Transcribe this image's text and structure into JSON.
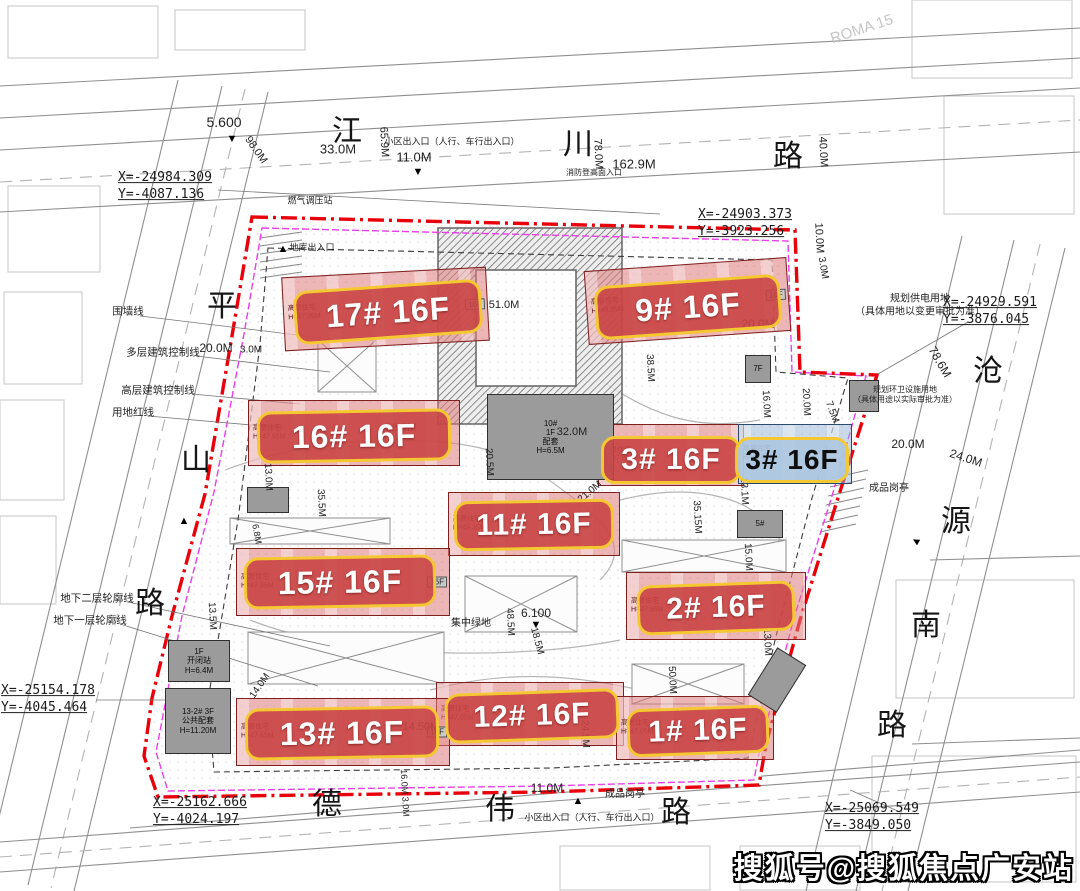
{
  "watermark": {
    "text": "搜狐号@搜狐焦点广安站"
  },
  "roads": {
    "top": "江川路",
    "left": "平山路",
    "right": "沧源南路",
    "bottom": "德伟路",
    "chars": [
      {
        "c": "江",
        "x": 347,
        "y": 128
      },
      {
        "c": "川",
        "x": 578,
        "y": 141
      },
      {
        "c": "路",
        "x": 788,
        "y": 153
      },
      {
        "c": "平",
        "x": 222,
        "y": 303
      },
      {
        "c": "山",
        "x": 196,
        "y": 457
      },
      {
        "c": "路",
        "x": 150,
        "y": 600
      },
      {
        "c": "沧",
        "x": 988,
        "y": 368
      },
      {
        "c": "源",
        "x": 956,
        "y": 518
      },
      {
        "c": "南",
        "x": 926,
        "y": 622
      },
      {
        "c": "路",
        "x": 892,
        "y": 722
      },
      {
        "c": "德",
        "x": 327,
        "y": 801
      },
      {
        "c": "伟",
        "x": 500,
        "y": 806
      },
      {
        "c": "路",
        "x": 676,
        "y": 809
      }
    ]
  },
  "buildings": [
    {
      "id": "17",
      "label": "17# 16F",
      "variant": "red",
      "chip": {
        "x": 388,
        "y": 312,
        "w": 188,
        "h": 54,
        "rot": -4,
        "fs": 32
      },
      "fp": {
        "x": 283,
        "y": 272,
        "w": 205,
        "h": 74,
        "rot": -3
      },
      "sub": [
        "高层住宅",
        "H=47.05M"
      ],
      "end": "16F"
    },
    {
      "id": "9",
      "label": "9# 16F",
      "variant": "red",
      "chip": {
        "x": 688,
        "y": 307,
        "w": 186,
        "h": 54,
        "rot": -4,
        "fs": 32
      },
      "fp": {
        "x": 586,
        "y": 264,
        "w": 203,
        "h": 74,
        "rot": -4
      },
      "sub": [
        "高层住宅",
        "H=49.35M"
      ],
      "end": "16F"
    },
    {
      "id": "16",
      "label": "16# 16F",
      "variant": "red",
      "chip": {
        "x": 354,
        "y": 436,
        "w": 194,
        "h": 52,
        "rot": -1,
        "fs": 32
      },
      "fp": {
        "x": 248,
        "y": 400,
        "w": 212,
        "h": 66,
        "rot": 0
      },
      "sub": [
        "高层住宅",
        "H=47.95M"
      ]
    },
    {
      "id": "3",
      "label": "3# 16F",
      "variant": "red",
      "chip": {
        "x": 671,
        "y": 460,
        "w": 140,
        "h": 48,
        "rot": 0,
        "fs": 30
      },
      "fp": {
        "x": 598,
        "y": 424,
        "w": 146,
        "h": 62,
        "rot": 0
      },
      "sub": [
        "高层住宅",
        "H=47.95M"
      ]
    },
    {
      "id": "3b",
      "label": "3# 16F",
      "variant": "blue",
      "chip": {
        "x": 792,
        "y": 460,
        "w": 114,
        "h": 46,
        "rot": 0,
        "fs": 28
      },
      "fp": {
        "x": 738,
        "y": 424,
        "w": 114,
        "h": 60,
        "rot": 0
      },
      "sub": [
        "高层住宅",
        "H=47.95M"
      ]
    },
    {
      "id": "11",
      "label": "11# 16F",
      "variant": "red",
      "chip": {
        "x": 534,
        "y": 525,
        "w": 160,
        "h": 50,
        "rot": -1,
        "fs": 30
      },
      "fp": {
        "x": 448,
        "y": 492,
        "w": 172,
        "h": 64,
        "rot": 0
      },
      "sub": [
        "高层住宅",
        "H=49.35M"
      ]
    },
    {
      "id": "15",
      "label": "15# 16F",
      "variant": "red",
      "chip": {
        "x": 340,
        "y": 582,
        "w": 192,
        "h": 52,
        "rot": -1,
        "fs": 32
      },
      "fp": {
        "x": 236,
        "y": 548,
        "w": 214,
        "h": 68,
        "rot": 0
      },
      "sub": [
        "高层住宅",
        "H=47.95M"
      ],
      "end": "16F"
    },
    {
      "id": "2",
      "label": "2# 16F",
      "variant": "red",
      "chip": {
        "x": 716,
        "y": 608,
        "w": 158,
        "h": 50,
        "rot": -2,
        "fs": 30
      },
      "fp": {
        "x": 626,
        "y": 572,
        "w": 180,
        "h": 68,
        "rot": 0
      },
      "sub": [
        "高层住宅",
        "H=47.95M"
      ]
    },
    {
      "id": "12",
      "label": "12# 16F",
      "variant": "red",
      "chip": {
        "x": 532,
        "y": 716,
        "w": 174,
        "h": 50,
        "rot": -2,
        "fs": 30
      },
      "fp": {
        "x": 436,
        "y": 682,
        "w": 188,
        "h": 64,
        "rot": 0
      },
      "sub": [
        "高层住宅",
        "H=47.05M"
      ]
    },
    {
      "id": "13",
      "label": "13# 16F",
      "variant": "red",
      "chip": {
        "x": 342,
        "y": 733,
        "w": 194,
        "h": 52,
        "rot": -1,
        "fs": 32
      },
      "fp": {
        "x": 236,
        "y": 698,
        "w": 214,
        "h": 68,
        "rot": 0
      },
      "sub": [
        "高层住宅",
        "H=47.65M"
      ],
      "end": "16F"
    },
    {
      "id": "1",
      "label": "1# 16F",
      "variant": "red",
      "chip": {
        "x": 698,
        "y": 731,
        "w": 142,
        "h": 48,
        "rot": -2,
        "fs": 30
      },
      "fp": {
        "x": 616,
        "y": 696,
        "w": 158,
        "h": 64,
        "rot": 0
      },
      "sub": [
        "高层住宅",
        "H=47.05M"
      ]
    }
  ],
  "gray_buildings": [
    {
      "x": 487,
      "y": 394,
      "w": 127,
      "h": 86,
      "lines": [
        "10#",
        "1F",
        "配套",
        "H=6.5M"
      ]
    },
    {
      "x": 168,
      "y": 640,
      "w": 62,
      "h": 42,
      "lines": [
        "1F",
        "开闭站",
        "H=6.4M"
      ]
    },
    {
      "x": 165,
      "y": 688,
      "w": 66,
      "h": 66,
      "lines": [
        "13-2# 3F",
        "公共配套",
        "H=11.20M"
      ]
    },
    {
      "x": 849,
      "y": 380,
      "w": 30,
      "h": 32,
      "lines": []
    },
    {
      "x": 737,
      "y": 510,
      "w": 46,
      "h": 28,
      "lines": [
        "5#"
      ]
    },
    {
      "x": 247,
      "y": 487,
      "w": 42,
      "h": 26,
      "lines": []
    },
    {
      "x": 745,
      "y": 355,
      "w": 26,
      "h": 28,
      "lines": [
        "7F"
      ]
    },
    {
      "x": 760,
      "y": 652,
      "w": 34,
      "h": 56,
      "rot": 32,
      "lines": []
    }
  ],
  "dimensions": [
    {
      "t": "5.600",
      "x": 224,
      "y": 122,
      "r": 0,
      "fs": 14
    },
    {
      "t": "98.0M",
      "x": 256,
      "y": 150,
      "r": 55,
      "fs": 11
    },
    {
      "t": "65.9M",
      "x": 384,
      "y": 142,
      "r": 87,
      "fs": 11
    },
    {
      "t": "33.0M",
      "x": 338,
      "y": 149,
      "r": 0,
      "fs": 13
    },
    {
      "t": "11.0M",
      "x": 414,
      "y": 157,
      "r": 0,
      "fs": 13
    },
    {
      "t": "162.9M",
      "x": 634,
      "y": 164,
      "r": 0,
      "fs": 13
    },
    {
      "t": "78.0M",
      "x": 598,
      "y": 154,
      "r": 87,
      "fs": 11
    },
    {
      "t": "40.0M",
      "x": 823,
      "y": 152,
      "r": 87,
      "fs": 11
    },
    {
      "t": "10.0M",
      "x": 819,
      "y": 238,
      "r": 87,
      "fs": 11
    },
    {
      "t": "3.0M",
      "x": 823,
      "y": 268,
      "r": 80,
      "fs": 10
    },
    {
      "t": "20.0M",
      "x": 758,
      "y": 324,
      "r": 0,
      "fs": 12
    },
    {
      "t": "20.0M",
      "x": 216,
      "y": 348,
      "r": 0,
      "fs": 12
    },
    {
      "t": "3.0M",
      "x": 251,
      "y": 350,
      "r": 0,
      "fs": 10
    },
    {
      "t": "78.6M",
      "x": 940,
      "y": 362,
      "r": 60,
      "fs": 12
    },
    {
      "t": "20.0M",
      "x": 908,
      "y": 444,
      "r": 0,
      "fs": 12
    },
    {
      "t": "24.0M",
      "x": 966,
      "y": 458,
      "r": 18,
      "fs": 12
    },
    {
      "t": "18.0M",
      "x": 401,
      "y": 428,
      "r": 0,
      "fs": 11
    },
    {
      "t": "32.0M",
      "x": 572,
      "y": 432,
      "r": 0,
      "fs": 11
    },
    {
      "t": "51.0M",
      "x": 504,
      "y": 305,
      "r": 0,
      "fs": 11
    },
    {
      "t": "20.5M",
      "x": 489,
      "y": 462,
      "r": 87,
      "fs": 10
    },
    {
      "t": "13.0M",
      "x": 268,
      "y": 477,
      "r": 87,
      "fs": 10
    },
    {
      "t": "35.5M",
      "x": 321,
      "y": 503,
      "r": 87,
      "fs": 10
    },
    {
      "t": "6.8M",
      "x": 257,
      "y": 534,
      "r": 80,
      "fs": 9
    },
    {
      "t": "38.5M",
      "x": 650,
      "y": 368,
      "r": 87,
      "fs": 10
    },
    {
      "t": "16.0M",
      "x": 766,
      "y": 404,
      "r": 87,
      "fs": 10
    },
    {
      "t": "20.0M",
      "x": 806,
      "y": 402,
      "r": 87,
      "fs": 10
    },
    {
      "t": "7.5M",
      "x": 832,
      "y": 412,
      "r": 70,
      "fs": 10
    },
    {
      "t": "13.1M",
      "x": 744,
      "y": 491,
      "r": 87,
      "fs": 10
    },
    {
      "t": "35.15M",
      "x": 697,
      "y": 517,
      "r": 87,
      "fs": 10
    },
    {
      "t": "21.0M",
      "x": 590,
      "y": 492,
      "r": -40,
      "fs": 10
    },
    {
      "t": "15.0M",
      "x": 748,
      "y": 557,
      "r": 87,
      "fs": 10
    },
    {
      "t": "48.5M",
      "x": 510,
      "y": 622,
      "r": 87,
      "fs": 10
    },
    {
      "t": "18.5M",
      "x": 537,
      "y": 641,
      "r": 75,
      "fs": 10
    },
    {
      "t": "13.0M",
      "x": 767,
      "y": 642,
      "r": 87,
      "fs": 10
    },
    {
      "t": "13.5M",
      "x": 212,
      "y": 616,
      "r": 87,
      "fs": 10
    },
    {
      "t": "14.0M",
      "x": 260,
      "y": 686,
      "r": -55,
      "fs": 10
    },
    {
      "t": "14.50M",
      "x": 421,
      "y": 727,
      "r": 0,
      "fs": 11
    },
    {
      "t": "24.5M",
      "x": 585,
      "y": 734,
      "r": 87,
      "fs": 10
    },
    {
      "t": "50.0M",
      "x": 672,
      "y": 680,
      "r": 87,
      "fs": 10
    },
    {
      "t": "16.0M 3.0M",
      "x": 405,
      "y": 793,
      "r": 87,
      "fs": 9
    },
    {
      "t": "11.0M",
      "x": 547,
      "y": 788,
      "r": 0,
      "fs": 12
    },
    {
      "t": "6.100",
      "x": 536,
      "y": 613,
      "r": 0,
      "fs": 12
    }
  ],
  "annotations": [
    {
      "t": "小区出入口（人行、车行出入口）",
      "x": 452,
      "y": 142,
      "fs": 9
    },
    {
      "t": "消防登高面入口",
      "x": 594,
      "y": 173,
      "fs": 8
    },
    {
      "t": "燃气调压站",
      "x": 310,
      "y": 201,
      "fs": 9
    },
    {
      "t": "地库出入口",
      "x": 312,
      "y": 248,
      "fs": 9
    },
    {
      "lines": [
        "规划供电用地",
        "（具体用地以变更审批为准）"
      ],
      "x": 920,
      "y": 306,
      "fs": 10
    },
    {
      "lines": [
        "规划环卫设施用地",
        "（具体用途以实际审批为准）"
      ],
      "x": 905,
      "y": 395,
      "fs": 8
    },
    {
      "t": "成品岗亭",
      "x": 889,
      "y": 489,
      "fs": 10
    },
    {
      "t": "成品岗亭",
      "x": 625,
      "y": 795,
      "fs": 10
    },
    {
      "t": "小区出入口（人行、车行出入口）",
      "x": 592,
      "y": 818,
      "fs": 9
    },
    {
      "t": "集中绿地",
      "x": 471,
      "y": 624,
      "fs": 10
    },
    {
      "t": "ROMA  15",
      "x": 862,
      "y": 30,
      "fs": 15,
      "r": -18,
      "light": true
    }
  ],
  "coordinates": [
    {
      "lines": [
        "X=-24984.309",
        "Y=-4087.136"
      ],
      "x": 165,
      "y": 187
    },
    {
      "lines": [
        "X=-24903.373",
        "Y=-3923.256"
      ],
      "x": 745,
      "y": 224
    },
    {
      "lines": [
        "X=-24929.591",
        "Y=-3876.045"
      ],
      "x": 990,
      "y": 312
    },
    {
      "lines": [
        "X=-25154.178",
        "Y=-4045.464"
      ],
      "x": 48,
      "y": 700
    },
    {
      "lines": [
        "X=-25162.666",
        "Y=-4024.197"
      ],
      "x": 200,
      "y": 812
    },
    {
      "lines": [
        "X=-25069.549",
        "Y=-3849.050"
      ],
      "x": 872,
      "y": 818
    }
  ],
  "legend": {
    "left": [
      {
        "t": "围墙线",
        "x": 128,
        "y": 311
      },
      {
        "t": "多层建筑控制线",
        "x": 163,
        "y": 352
      },
      {
        "t": "高层建筑控制线",
        "x": 158,
        "y": 390
      },
      {
        "t": "用地红线",
        "x": 133,
        "y": 412
      }
    ],
    "bottom": [
      {
        "t": "地下二层轮廓线",
        "x": 97,
        "y": 598
      },
      {
        "t": "地下一层轮廓线",
        "x": 90,
        "y": 620
      }
    ]
  },
  "markers": [
    {
      "g": "▼",
      "x": 232,
      "y": 139
    },
    {
      "g": "▼",
      "x": 418,
      "y": 172
    },
    {
      "g": "▲",
      "x": 184,
      "y": 521
    },
    {
      "g": "▲",
      "x": 283,
      "y": 249
    },
    {
      "g": "▲",
      "x": 578,
      "y": 801
    },
    {
      "g": "▲",
      "x": 916,
      "y": 541,
      "r": -60
    },
    {
      "g": "▼",
      "x": 536,
      "y": 625
    }
  ],
  "colors": {
    "boundary_red": "#e8000b",
    "inner_magenta": "#e93ee9",
    "chip_red": "#c94444",
    "chip_border_yellow": "#f5c832",
    "chip_blue": "#adc7e0",
    "building_fill": "#de7a7a",
    "gray_building": "#9b9b9b"
  }
}
